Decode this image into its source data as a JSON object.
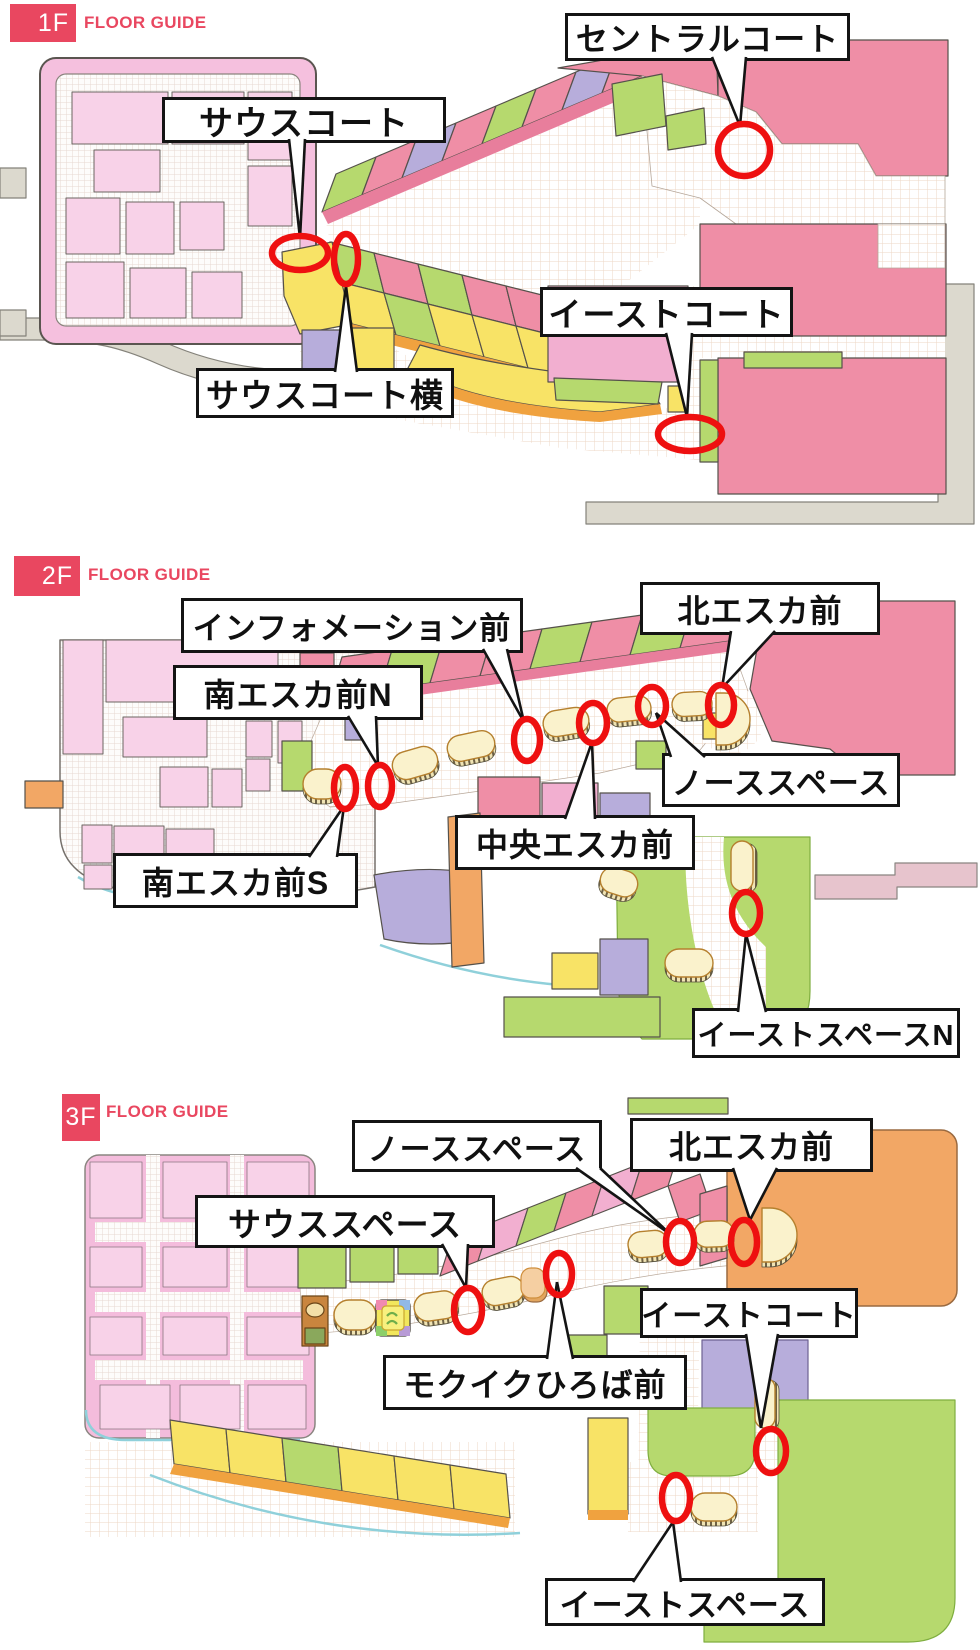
{
  "marker_color": "#ee1010",
  "accent_red": "#e94760",
  "floors": [
    {
      "id": "1f",
      "badge": "1F",
      "guide": "FLOOR GUIDE",
      "labels": [
        {
          "name": "south-court",
          "text": "サウスコート",
          "x": 162,
          "y": 97,
          "w": 284,
          "h": 46,
          "fs": 34,
          "tail": {
            "bx": 297,
            "by": 143,
            "bw": 16,
            "ax": 300,
            "ay": 238
          }
        },
        {
          "name": "central-court",
          "text": "セントラルコート",
          "x": 565,
          "y": 13,
          "w": 285,
          "h": 48,
          "fs": 32,
          "tail": {
            "bx": 729,
            "by": 61,
            "bw": 34,
            "ax": 740,
            "ay": 126
          }
        },
        {
          "name": "east-court",
          "text": "イーストコート",
          "x": 540,
          "y": 287,
          "w": 253,
          "h": 50,
          "fs": 33,
          "tail": {
            "bx": 679,
            "by": 337,
            "bw": 26,
            "ax": 687,
            "ay": 417
          }
        },
        {
          "name": "south-court-side",
          "text": "サウスコート横",
          "x": 196,
          "y": 368,
          "w": 258,
          "h": 50,
          "fs": 33,
          "tail": {
            "bx": 346,
            "by": 368,
            "bw": 22,
            "ax": 346,
            "ay": 286
          }
        }
      ],
      "markers": [
        {
          "cx": 300,
          "cy": 253,
          "rx": 28,
          "ry": 17
        },
        {
          "cx": 346,
          "cy": 259,
          "rx": 12,
          "ry": 25
        },
        {
          "cx": 744,
          "cy": 150,
          "rx": 26,
          "ry": 26
        },
        {
          "cx": 690,
          "cy": 434,
          "rx": 32,
          "ry": 17
        }
      ]
    },
    {
      "id": "2f",
      "badge": "2F",
      "guide": "FLOOR GUIDE",
      "labels": [
        {
          "name": "information-mae",
          "text": "インフォメーション前",
          "x": 181,
          "y": 598,
          "w": 342,
          "h": 55,
          "fs": 31,
          "tail": {
            "bx": 495,
            "by": 653,
            "bw": 24,
            "ax": 524,
            "ay": 722
          }
        },
        {
          "name": "kita-esca-mae",
          "text": "北エスカ前",
          "x": 640,
          "y": 582,
          "w": 240,
          "h": 53,
          "fs": 32,
          "tail": {
            "bx": 753,
            "by": 635,
            "bw": 44,
            "ax": 722,
            "ay": 688
          }
        },
        {
          "name": "minami-esca-mae-n",
          "text": "南エスカ前N",
          "x": 173,
          "y": 665,
          "w": 250,
          "h": 55,
          "fs": 32,
          "tail": {
            "bx": 362,
            "by": 720,
            "bw": 28,
            "ax": 378,
            "ay": 766
          }
        },
        {
          "name": "north-space",
          "text": "ノーススペース",
          "x": 662,
          "y": 753,
          "w": 238,
          "h": 54,
          "fs": 31,
          "tail": {
            "bx": 688,
            "by": 753,
            "bw": 34,
            "ax": 656,
            "ay": 713
          }
        },
        {
          "name": "chuo-esca-mae",
          "text": "中央エスカ前",
          "x": 455,
          "y": 815,
          "w": 240,
          "h": 55,
          "fs": 32,
          "tail": {
            "bx": 580,
            "by": 815,
            "bw": 30,
            "ax": 592,
            "ay": 742
          }
        },
        {
          "name": "minami-esca-mae-s",
          "text": "南エスカ前S",
          "x": 113,
          "y": 853,
          "w": 245,
          "h": 55,
          "fs": 32,
          "tail": {
            "bx": 323,
            "by": 853,
            "bw": 28,
            "ax": 344,
            "ay": 806
          }
        },
        {
          "name": "east-space-n",
          "text": "イーストスペースN",
          "x": 692,
          "y": 1008,
          "w": 268,
          "h": 50,
          "fs": 29,
          "tail": {
            "bx": 752,
            "by": 1008,
            "bw": 28,
            "ax": 746,
            "ay": 934
          }
        }
      ],
      "markers": [
        {
          "cx": 345,
          "cy": 788,
          "rx": 11,
          "ry": 21
        },
        {
          "cx": 380,
          "cy": 786,
          "rx": 12,
          "ry": 21
        },
        {
          "cx": 527,
          "cy": 740,
          "rx": 13,
          "ry": 21
        },
        {
          "cx": 593,
          "cy": 723,
          "rx": 14,
          "ry": 20
        },
        {
          "cx": 652,
          "cy": 706,
          "rx": 14,
          "ry": 19
        },
        {
          "cx": 721,
          "cy": 705,
          "rx": 13,
          "ry": 20
        },
        {
          "cx": 746,
          "cy": 913,
          "rx": 14,
          "ry": 21
        }
      ]
    },
    {
      "id": "3f",
      "badge": "3F",
      "guide": "FLOOR GUIDE",
      "labels": [
        {
          "name": "north-space",
          "text": "ノーススペース",
          "x": 352,
          "y": 1120,
          "w": 250,
          "h": 52,
          "fs": 31,
          "tail": {
            "bx": 588,
            "by": 1172,
            "bw": 24,
            "ax": 670,
            "ay": 1234
          }
        },
        {
          "name": "kita-esca-mae",
          "text": "北エスカ前",
          "x": 630,
          "y": 1118,
          "w": 243,
          "h": 54,
          "fs": 32,
          "tail": {
            "bx": 755,
            "by": 1172,
            "bw": 44,
            "ax": 750,
            "ay": 1220
          }
        },
        {
          "name": "south-space",
          "text": "サウススペース",
          "x": 195,
          "y": 1195,
          "w": 300,
          "h": 53,
          "fs": 33,
          "tail": {
            "bx": 455,
            "by": 1248,
            "bw": 26,
            "ax": 466,
            "ay": 1288
          }
        },
        {
          "name": "east-court",
          "text": "イーストコート",
          "x": 640,
          "y": 1288,
          "w": 218,
          "h": 50,
          "fs": 30,
          "tail": {
            "bx": 762,
            "by": 1338,
            "bw": 32,
            "ax": 761,
            "ay": 1428
          }
        },
        {
          "name": "mokuiku-hiroba-mae",
          "text": "モクイクひろば前",
          "x": 383,
          "y": 1355,
          "w": 304,
          "h": 55,
          "fs": 32,
          "tail": {
            "bx": 560,
            "by": 1355,
            "bw": 26,
            "ax": 557,
            "ay": 1282
          }
        },
        {
          "name": "east-space",
          "text": "イーストスペース",
          "x": 545,
          "y": 1578,
          "w": 280,
          "h": 48,
          "fs": 31,
          "tail": {
            "bx": 657,
            "by": 1578,
            "bw": 48,
            "ax": 673,
            "ay": 1522
          }
        }
      ],
      "markers": [
        {
          "cx": 468,
          "cy": 1310,
          "rx": 14,
          "ry": 22
        },
        {
          "cx": 559,
          "cy": 1274,
          "rx": 13,
          "ry": 21
        },
        {
          "cx": 680,
          "cy": 1242,
          "rx": 14,
          "ry": 21
        },
        {
          "cx": 744,
          "cy": 1242,
          "rx": 13,
          "ry": 22
        },
        {
          "cx": 771,
          "cy": 1451,
          "rx": 15,
          "ry": 22
        },
        {
          "cx": 676,
          "cy": 1498,
          "rx": 14,
          "ry": 23
        }
      ]
    }
  ]
}
